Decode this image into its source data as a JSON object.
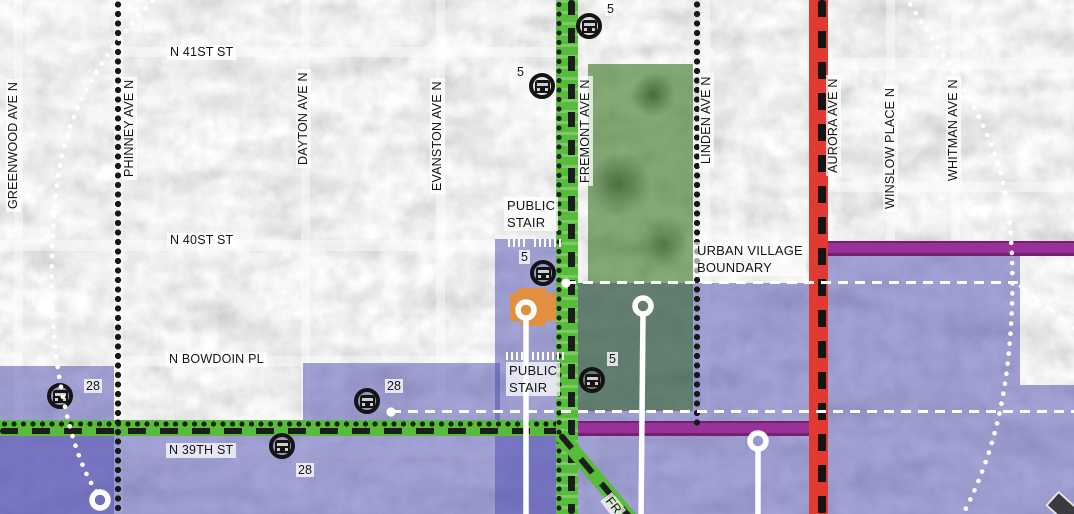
{
  "street_labels": {
    "n_41st_st": "N 41ST ST",
    "n_40st_st": "N 40ST ST",
    "n_bowdoin_pl": "N BOWDOIN PL",
    "n_39th_st": "N 39TH ST",
    "greenwood_ave_n": "GREENWOOD AVE N",
    "phinney_ave_n": "PHINNEY AVE N",
    "dayton_ave_n": "DAYTON AVE N",
    "evanston_ave_n": "EVANSTON AVE N",
    "fremont_ave_n": "FREMONT AVE N",
    "linden_ave_n": "LINDEN AVE N",
    "aurora_ave_n": "AURORA AVE N",
    "winslow_place_n": "WINSLOW PLACE N",
    "whitman_ave_n": "WHITMAN AVE N",
    "fremont_way_partial": "FR"
  },
  "annotations": {
    "public_stair_upper": {
      "line1": "PUBLIC",
      "line2": "STAIR"
    },
    "public_stair_lower": {
      "line1": "PUBLIC",
      "line2": "STAIR"
    },
    "urban_village_boundary": {
      "line1": "URBAN VILLAGE",
      "line2": "BOUNDARY"
    }
  },
  "bus_stops": [
    {
      "route": "5"
    },
    {
      "route": "5"
    },
    {
      "route": "5"
    },
    {
      "route": "5"
    },
    {
      "route": "28"
    },
    {
      "route": "28"
    },
    {
      "route": "28"
    }
  ],
  "colors": {
    "bike_route_green": "#58bc3b",
    "aurora_corridor_red": "#e23a30",
    "arterial_purple": "#9a3198",
    "park_green": "#3e7626",
    "urban_village_overlay_blue": "#504eb0",
    "key_site_orange": "#e2903f",
    "boundary_dash_white": "#ffffff",
    "parcel_dot_black": "#181818"
  }
}
